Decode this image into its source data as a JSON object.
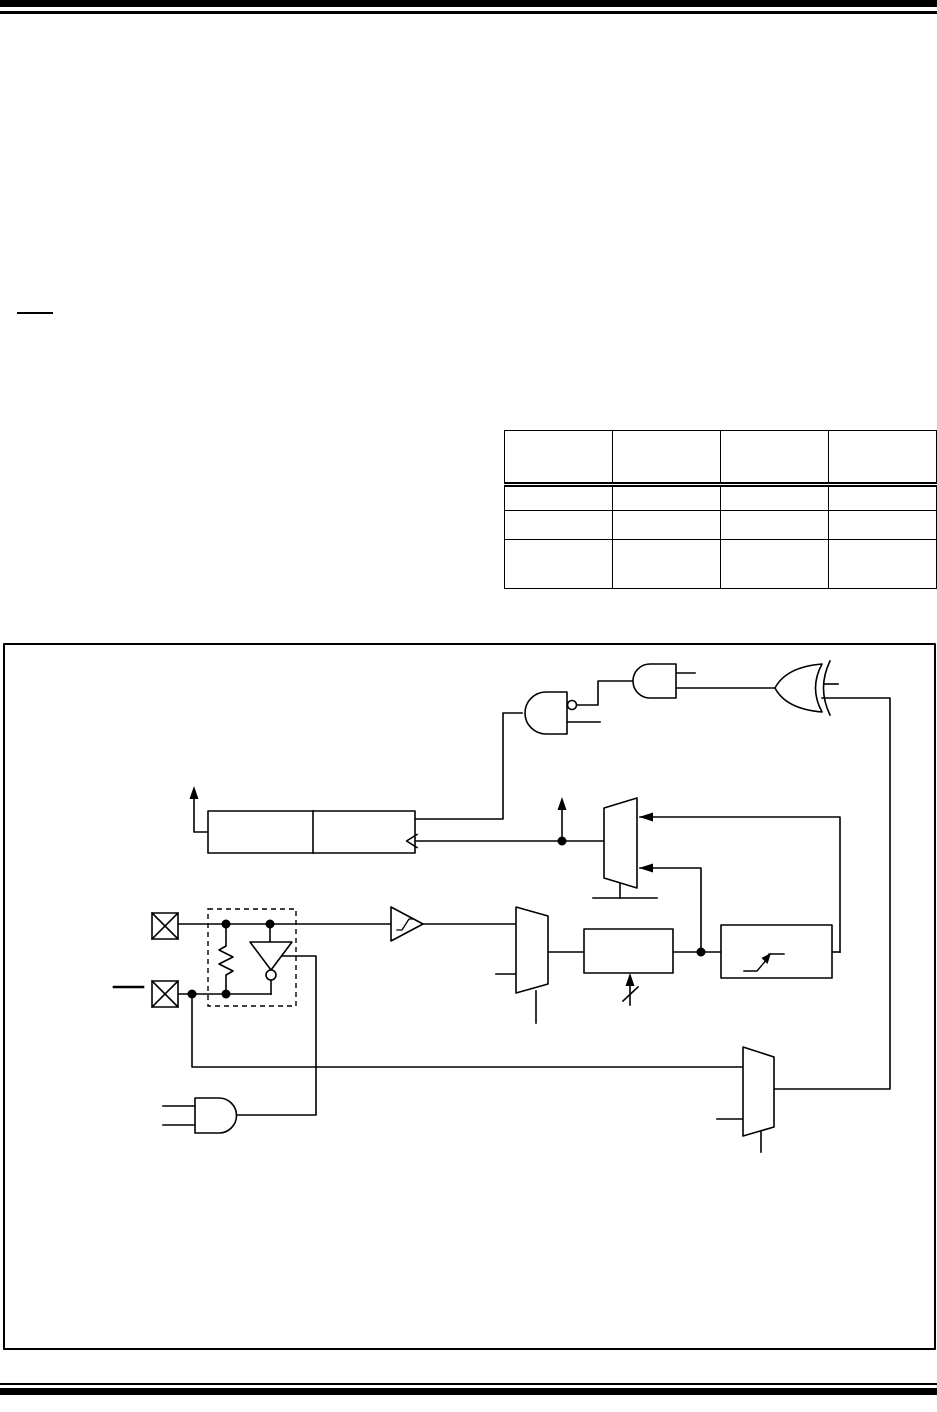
{
  "colors": {
    "ink": "#000000",
    "paper": "#ffffff"
  },
  "header": {
    "rule_count": 2
  },
  "footer": {
    "rule_count": 2
  },
  "overline_fragment": "",
  "table": {
    "column_count": 4,
    "header": [
      "",
      "",
      "",
      ""
    ],
    "rows": [
      [
        "",
        "",
        "",
        ""
      ],
      [
        "",
        "",
        "",
        ""
      ],
      [
        "",
        "",
        "",
        ""
      ]
    ]
  },
  "diagram": {
    "frame": "figure-border",
    "components": [
      "inverted-input-and-gate",
      "and-gate",
      "xor-gate",
      "timer-register-pair",
      "overflow-arrow",
      "clock-select-mux",
      "io-pin-top",
      "io-pin-bottom",
      "oscillator-dashed-box",
      "feedback-resistor",
      "oscillator-inverter",
      "schmitt-trigger-buffer",
      "source-select-mux",
      "prescaler-box",
      "synchronizer-box",
      "gate-source-mux",
      "enable-and-gate"
    ]
  }
}
